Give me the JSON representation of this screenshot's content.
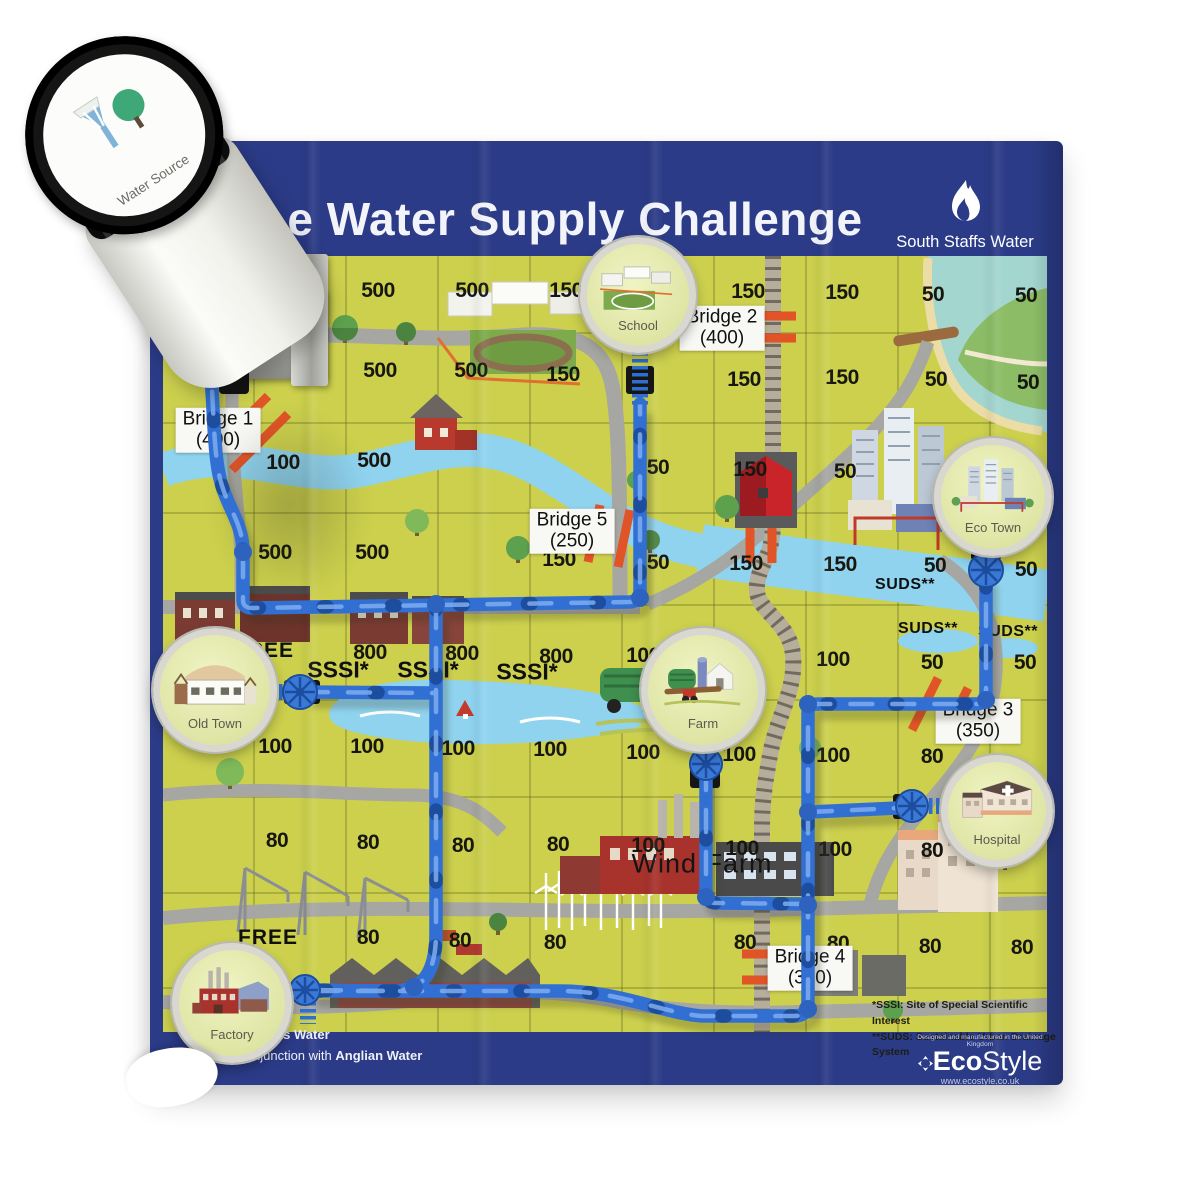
{
  "board": {
    "title": "e Water Supply Challenge"
  },
  "brand": {
    "name": "South Staffs Water"
  },
  "water_source": {
    "label": "Water Source"
  },
  "locations": {
    "school": {
      "label": "School"
    },
    "eco_town": {
      "label": "Eco Town"
    },
    "old_town": {
      "label": "Old Town"
    },
    "farm": {
      "label": "Farm"
    },
    "hospital": {
      "label": "Hospital"
    },
    "factory": {
      "label": "Factory"
    }
  },
  "bridges": [
    {
      "name": "Bridge 1",
      "cost": "(400)",
      "x": 218,
      "y": 430
    },
    {
      "name": "Bridge 2",
      "cost": "(400)",
      "x": 722,
      "y": 328
    },
    {
      "name": "Bridge 3",
      "cost": "(350)",
      "x": 978,
      "y": 721
    },
    {
      "name": "Bridge 4",
      "cost": "(300)",
      "x": 810,
      "y": 968
    },
    {
      "name": "Bridge 5",
      "cost": "(250)",
      "x": 572,
      "y": 531
    }
  ],
  "grid_numbers": [
    {
      "v": "500",
      "x": 378,
      "y": 291
    },
    {
      "v": "500",
      "x": 472,
      "y": 291
    },
    {
      "v": "150",
      "x": 566,
      "y": 291
    },
    {
      "v": "150",
      "x": 748,
      "y": 292
    },
    {
      "v": "150",
      "x": 842,
      "y": 293
    },
    {
      "v": "50",
      "x": 933,
      "y": 295
    },
    {
      "v": "50",
      "x": 1026,
      "y": 296
    },
    {
      "v": "500",
      "x": 281,
      "y": 372
    },
    {
      "v": "500",
      "x": 380,
      "y": 371
    },
    {
      "v": "500",
      "x": 471,
      "y": 371
    },
    {
      "v": "150",
      "x": 563,
      "y": 375
    },
    {
      "v": "150",
      "x": 744,
      "y": 380
    },
    {
      "v": "150",
      "x": 842,
      "y": 378
    },
    {
      "v": "50",
      "x": 936,
      "y": 380
    },
    {
      "v": "50",
      "x": 1028,
      "y": 383
    },
    {
      "v": "100",
      "x": 283,
      "y": 463
    },
    {
      "v": "500",
      "x": 374,
      "y": 461
    },
    {
      "v": "50",
      "x": 658,
      "y": 468
    },
    {
      "v": "150",
      "x": 750,
      "y": 470
    },
    {
      "v": "50",
      "x": 845,
      "y": 472
    },
    {
      "v": "500",
      "x": 275,
      "y": 553
    },
    {
      "v": "500",
      "x": 372,
      "y": 553
    },
    {
      "v": "150",
      "x": 559,
      "y": 560
    },
    {
      "v": "50",
      "x": 658,
      "y": 563
    },
    {
      "v": "150",
      "x": 746,
      "y": 564
    },
    {
      "v": "150",
      "x": 840,
      "y": 565
    },
    {
      "v": "50",
      "x": 935,
      "y": 566
    },
    {
      "v": "50",
      "x": 1026,
      "y": 570
    },
    {
      "v": "800",
      "x": 370,
      "y": 653
    },
    {
      "v": "800",
      "x": 462,
      "y": 654
    },
    {
      "v": "800",
      "x": 556,
      "y": 657
    },
    {
      "v": "100",
      "x": 643,
      "y": 656
    },
    {
      "v": "100",
      "x": 833,
      "y": 660
    },
    {
      "v": "50",
      "x": 932,
      "y": 663
    },
    {
      "v": "50",
      "x": 1025,
      "y": 663
    },
    {
      "v": "100",
      "x": 275,
      "y": 747
    },
    {
      "v": "100",
      "x": 367,
      "y": 747
    },
    {
      "v": "100",
      "x": 458,
      "y": 749
    },
    {
      "v": "100",
      "x": 550,
      "y": 750
    },
    {
      "v": "100",
      "x": 643,
      "y": 753
    },
    {
      "v": "100",
      "x": 739,
      "y": 755
    },
    {
      "v": "100",
      "x": 833,
      "y": 756
    },
    {
      "v": "80",
      "x": 932,
      "y": 757
    },
    {
      "v": "80",
      "x": 277,
      "y": 841
    },
    {
      "v": "80",
      "x": 368,
      "y": 843
    },
    {
      "v": "80",
      "x": 463,
      "y": 846
    },
    {
      "v": "80",
      "x": 558,
      "y": 845
    },
    {
      "v": "100",
      "x": 648,
      "y": 846
    },
    {
      "v": "100",
      "x": 742,
      "y": 849
    },
    {
      "v": "100",
      "x": 835,
      "y": 850
    },
    {
      "v": "80",
      "x": 932,
      "y": 851
    },
    {
      "v": "80",
      "x": 368,
      "y": 938
    },
    {
      "v": "80",
      "x": 460,
      "y": 941
    },
    {
      "v": "80",
      "x": 555,
      "y": 943
    },
    {
      "v": "80",
      "x": 745,
      "y": 943
    },
    {
      "v": "80",
      "x": 838,
      "y": 944
    },
    {
      "v": "80",
      "x": 930,
      "y": 947
    },
    {
      "v": "80",
      "x": 1022,
      "y": 948
    }
  ],
  "area_labels": {
    "sssi": [
      {
        "text": "SSSI*",
        "x": 338,
        "y": 670
      },
      {
        "text": "SSSI*",
        "x": 428,
        "y": 670
      },
      {
        "text": "SSSI*",
        "x": 527,
        "y": 672
      }
    ],
    "suds": [
      {
        "text": "SUDS**",
        "x": 905,
        "y": 585
      },
      {
        "text": "SUDS**",
        "x": 928,
        "y": 629
      },
      {
        "text": "SUDS**",
        "x": 1008,
        "y": 632
      }
    ],
    "free": [
      {
        "text": "FREE",
        "x": 264,
        "y": 651
      },
      {
        "text": "FREE",
        "x": 268,
        "y": 938
      }
    ],
    "wind_farm": {
      "text": "Wind Farm",
      "x": 702,
      "y": 864
    }
  },
  "footnotes": {
    "sssi": "*SSSI: Site of Special Scientific Interest",
    "suds": "**SUDS: Sustainable Urban Drainage System"
  },
  "credits": {
    "line1": "nes Water",
    "line2_r": "R",
    "line2_rest": "njunction with ",
    "line2_bold": "Anglian Water"
  },
  "manufacturer": {
    "tagline": "Designed and manufactured in the United Kingdom",
    "brand_bold": "Eco",
    "brand_light": "Style",
    "url": "www.ecostyle.co.uk"
  },
  "colors": {
    "board_blue": "#2b3b87",
    "map_green": "#ccd04d",
    "river": "#8fd3ef",
    "pipe_blue": "#3170d2",
    "bridge_orange": "#e05427"
  }
}
